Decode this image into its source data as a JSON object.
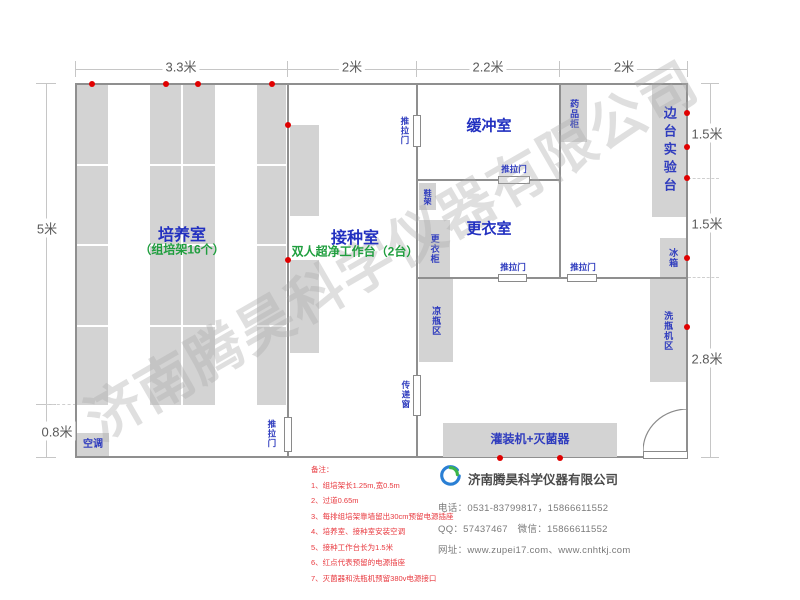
{
  "watermark": "济南腾昊科学仪器有限公司",
  "dimensions": {
    "top": [
      "3.3米",
      "2米",
      "2.2米",
      "2米"
    ],
    "left_height": "5米",
    "left_aisle": "0.8米",
    "right": [
      "1.5米",
      "1.5米",
      "2.8米"
    ]
  },
  "rooms": {
    "cultivation": {
      "name": "培养室",
      "sub": "（组培架16个）"
    },
    "inoculation": {
      "name": "接种室",
      "sub": "双人超净工作台（2台）"
    },
    "buffer": {
      "name": "缓冲室"
    },
    "dressing": {
      "name": "更衣室"
    }
  },
  "fixtures": {
    "sliding_door": "推拉门",
    "transfer_window": "传递窗",
    "medicine_cabinet": "药品柜",
    "side_bench": "边台实验台",
    "fridge": "冰箱",
    "washer_area": "洗瓶机区",
    "cooling_area": "凉瓶区",
    "shoe_rack": "鞋架",
    "wardrobe": "更衣柜",
    "air_conditioner": "空调",
    "filler_sterilizer": "灌装机+灭菌器"
  },
  "notes": {
    "title": "备注：",
    "items": [
      "1、组培架长1.25m,宽0.5m",
      "2、过道0.65m",
      "3、每排组培架靠墙留出30cm预留电源插座",
      "4、培养室、接种室安装空调",
      "5、接种工作台长为1.5米",
      "6、红点代表预留的电源插座",
      "7、灭菌器和洗瓶机预留380v电源接口"
    ]
  },
  "company": {
    "name": "济南腾昊科学仪器有限公司",
    "phone": "电话：0531-83799817，15866611552",
    "qq_wechat": "QQ：57437467　微信：15866611552",
    "website": "网址：www.zupei17.com、www.cnhtkj.com"
  },
  "colors": {
    "wall": "#8f8f8f",
    "furniture": "#d3d3d3",
    "room_label": "#2230c0",
    "sub_label": "#1f9e3e",
    "socket_dot": "#e00000",
    "note_text": "#e8393f"
  }
}
